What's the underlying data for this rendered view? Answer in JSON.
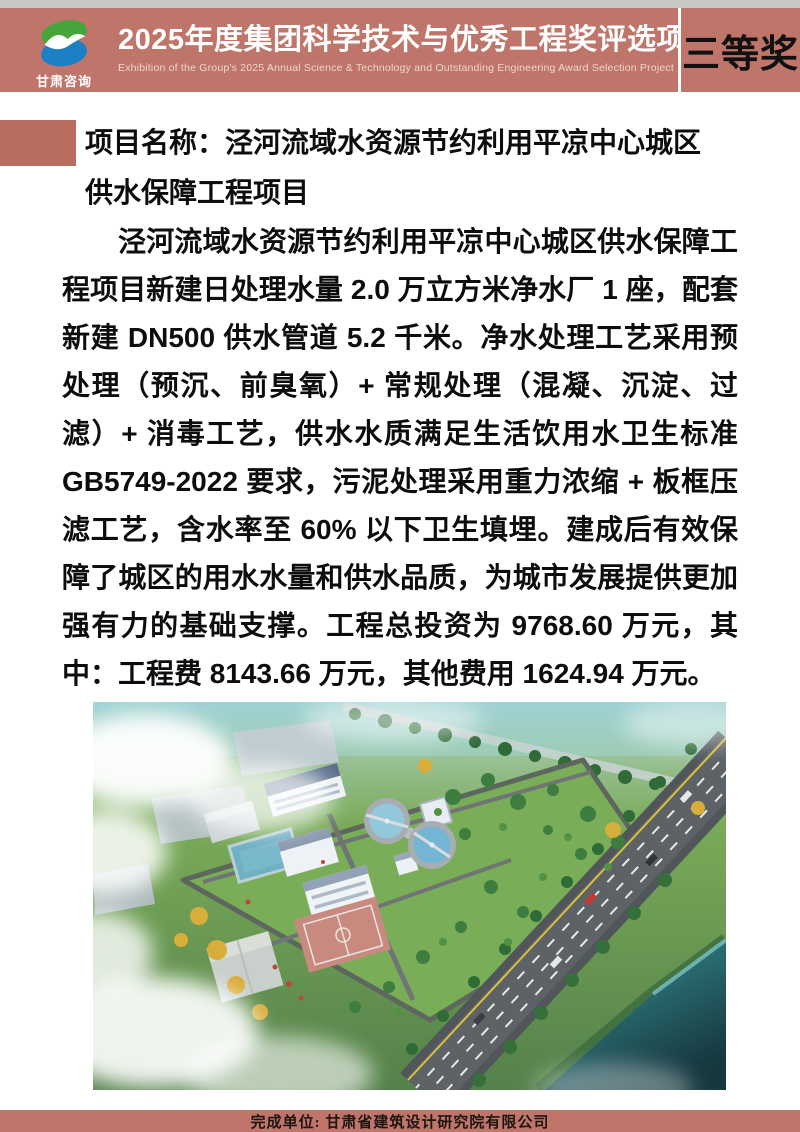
{
  "colors": {
    "accent": "#c0756a",
    "accent-dark": "#b96d61",
    "top-strip": "#c9c9c4",
    "banner-text": "#ffffff",
    "banner-subtext": "#edd6d0",
    "award-text": "#111111",
    "text": "#0d0d0d",
    "logo-green": "#46a63b",
    "logo-blue": "#1d7fc4"
  },
  "header": {
    "logo_text": "甘肃咨询",
    "title": "2025年度集团科学技术与优秀工程奖评选项目展",
    "subtitle": "Exhibition of the Group's 2025 Annual Science & Technology and Outstanding Engineering Award Selection Project",
    "award": "三等奖"
  },
  "project": {
    "name_line1": "项目名称：泾河流域水资源节约利用平凉中心城区",
    "name_line2": "供水保障工程项目",
    "description": "泾河流域水资源节约利用平凉中心城区供水保障工程项目新建日处理水量 2.0 万立方米净水厂 1 座，配套新建 DN500 供水管道 5.2 千米。净水处理工艺采用预处理（预沉、前臭氧）+ 常规处理（混凝、沉淀、过滤）+ 消毒工艺，供水水质满足生活饮用水卫生标准 GB5749-2022 要求，污泥处理采用重力浓缩 + 板框压滤工艺，含水率至 60% 以下卫生填埋。建成后有效保障了城区的用水水量和供水品质，为城市发展提供更加强有力的基础支撑。工程总投资为 9768.60 万元，其中：工程费 8143.66 万元，其他费用 1624.94 万元。"
  },
  "footer": {
    "credit": "完成单位: 甘肃省建筑设计研究院有限公司"
  }
}
